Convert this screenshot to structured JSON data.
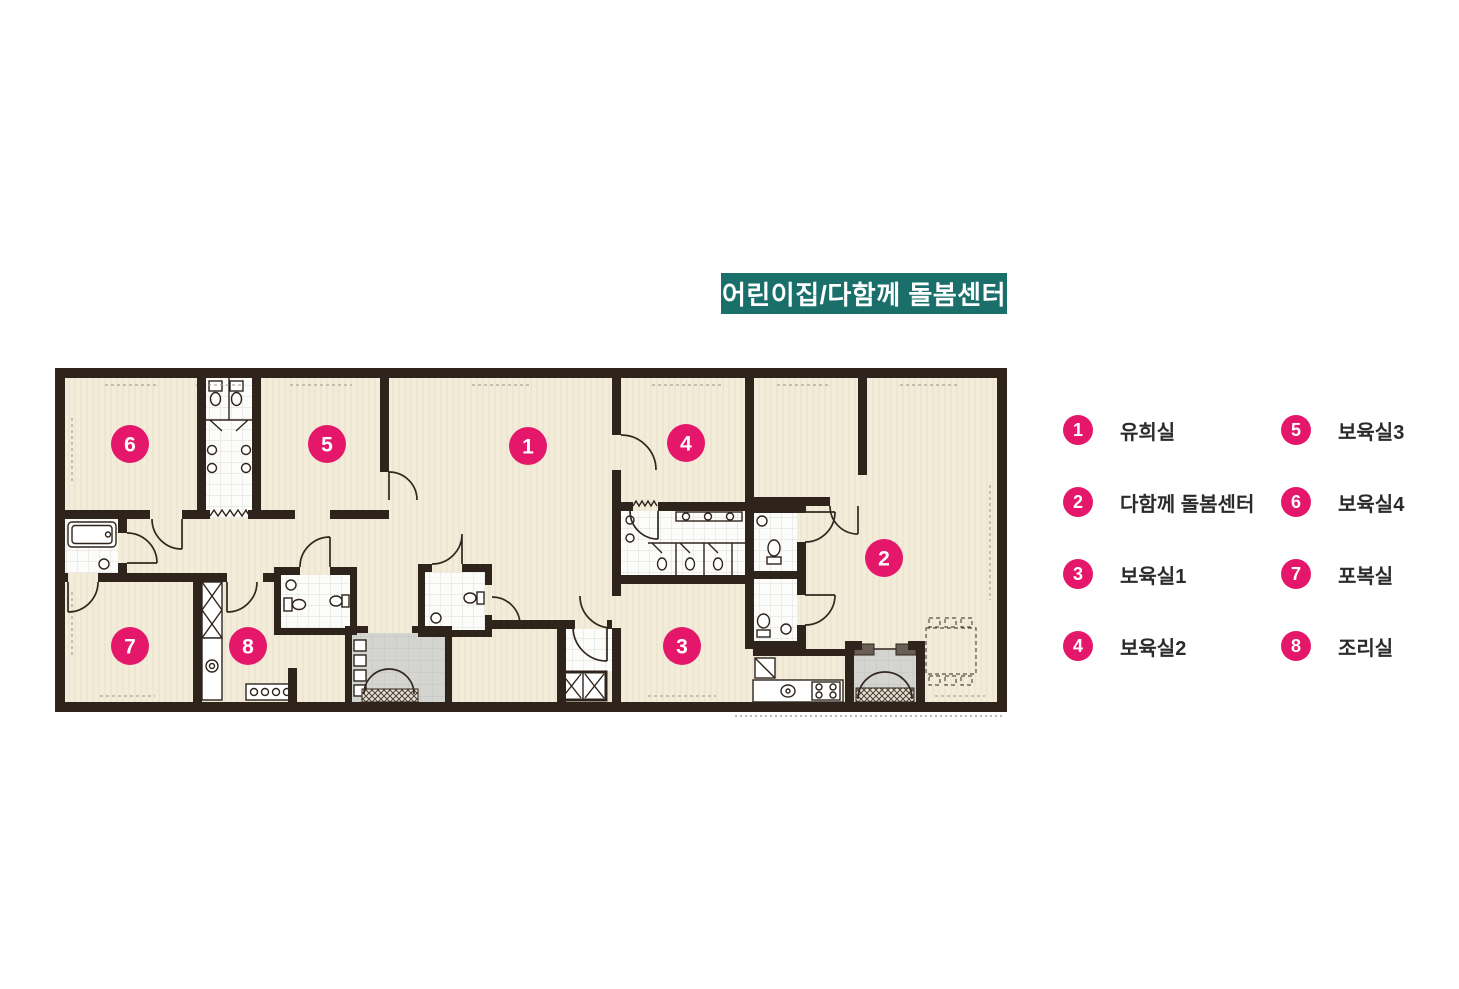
{
  "title": {
    "text": "어린이집/다함께 돌봄센터",
    "bg_color": "#1a6f6b",
    "text_color": "#ffffff"
  },
  "colors": {
    "wall": "#2e241c",
    "floor_cream": "#f2ecd9",
    "tile_white": "#fcfcfb",
    "utility_gray": "#d4d5d1",
    "marker_pink": "#e5176b"
  },
  "legend": {
    "columns": [
      {
        "items": [
          {
            "num": "1",
            "label": "유희실"
          },
          {
            "num": "2",
            "label": "다함께 돌봄센터"
          },
          {
            "num": "3",
            "label": "보육실1"
          },
          {
            "num": "4",
            "label": "보육실2"
          }
        ]
      },
      {
        "items": [
          {
            "num": "5",
            "label": "보육실3"
          },
          {
            "num": "6",
            "label": "보육실4"
          },
          {
            "num": "7",
            "label": "포복실"
          },
          {
            "num": "8",
            "label": "조리실"
          }
        ]
      }
    ]
  },
  "plan": {
    "markers": [
      {
        "num": "1"
      },
      {
        "num": "2"
      },
      {
        "num": "3"
      },
      {
        "num": "4"
      },
      {
        "num": "5"
      },
      {
        "num": "6"
      },
      {
        "num": "7"
      },
      {
        "num": "8"
      }
    ]
  }
}
